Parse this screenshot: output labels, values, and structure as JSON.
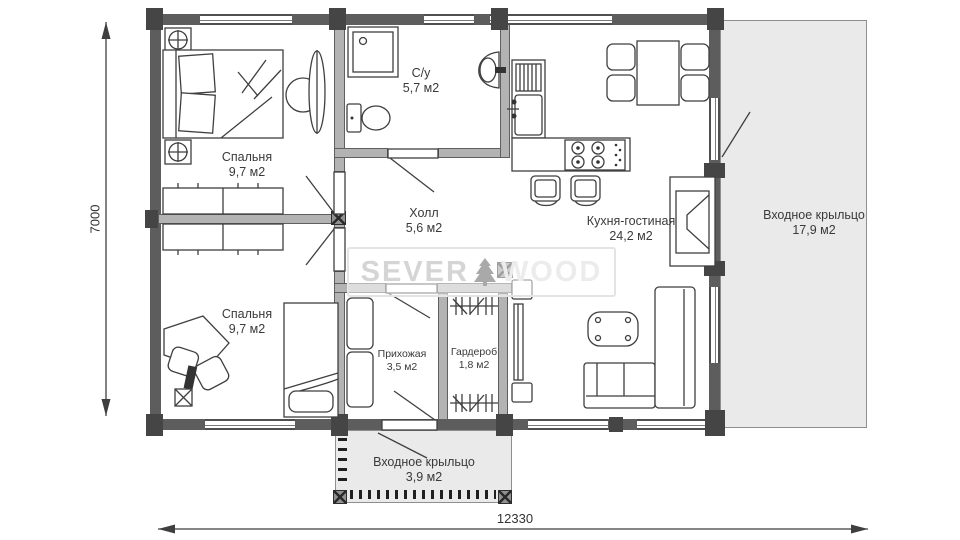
{
  "plan": {
    "rooms": [
      {
        "name": "Спальня",
        "area": "9,7 м2"
      },
      {
        "name": "С/у",
        "area": "5,7 м2"
      },
      {
        "name": "Холл",
        "area": "5,6 м2"
      },
      {
        "name": "Кухня-гостиная",
        "area": "24,2 м2"
      },
      {
        "name": "Спальня",
        "area": "9,7 м2"
      },
      {
        "name": "Прихожая",
        "area": "3,5 м2"
      },
      {
        "name": "Гардероб",
        "area": "1,8 м2"
      },
      {
        "name": "Входное крыльцо",
        "area": "17,9 м2"
      },
      {
        "name": "Входное крыльцо",
        "area": "3,9 м2"
      }
    ],
    "dimensions": {
      "width": "12330",
      "height": "7000"
    },
    "watermark": {
      "part1": "SEVER",
      "part2": "WOOD",
      "icon": "spruce-tree-icon"
    },
    "colors": {
      "wall": "#5d5d5d",
      "porch_fill": "#eaeaea",
      "line": "#3f3f3f",
      "watermark_text": "#d5d5d5"
    }
  }
}
